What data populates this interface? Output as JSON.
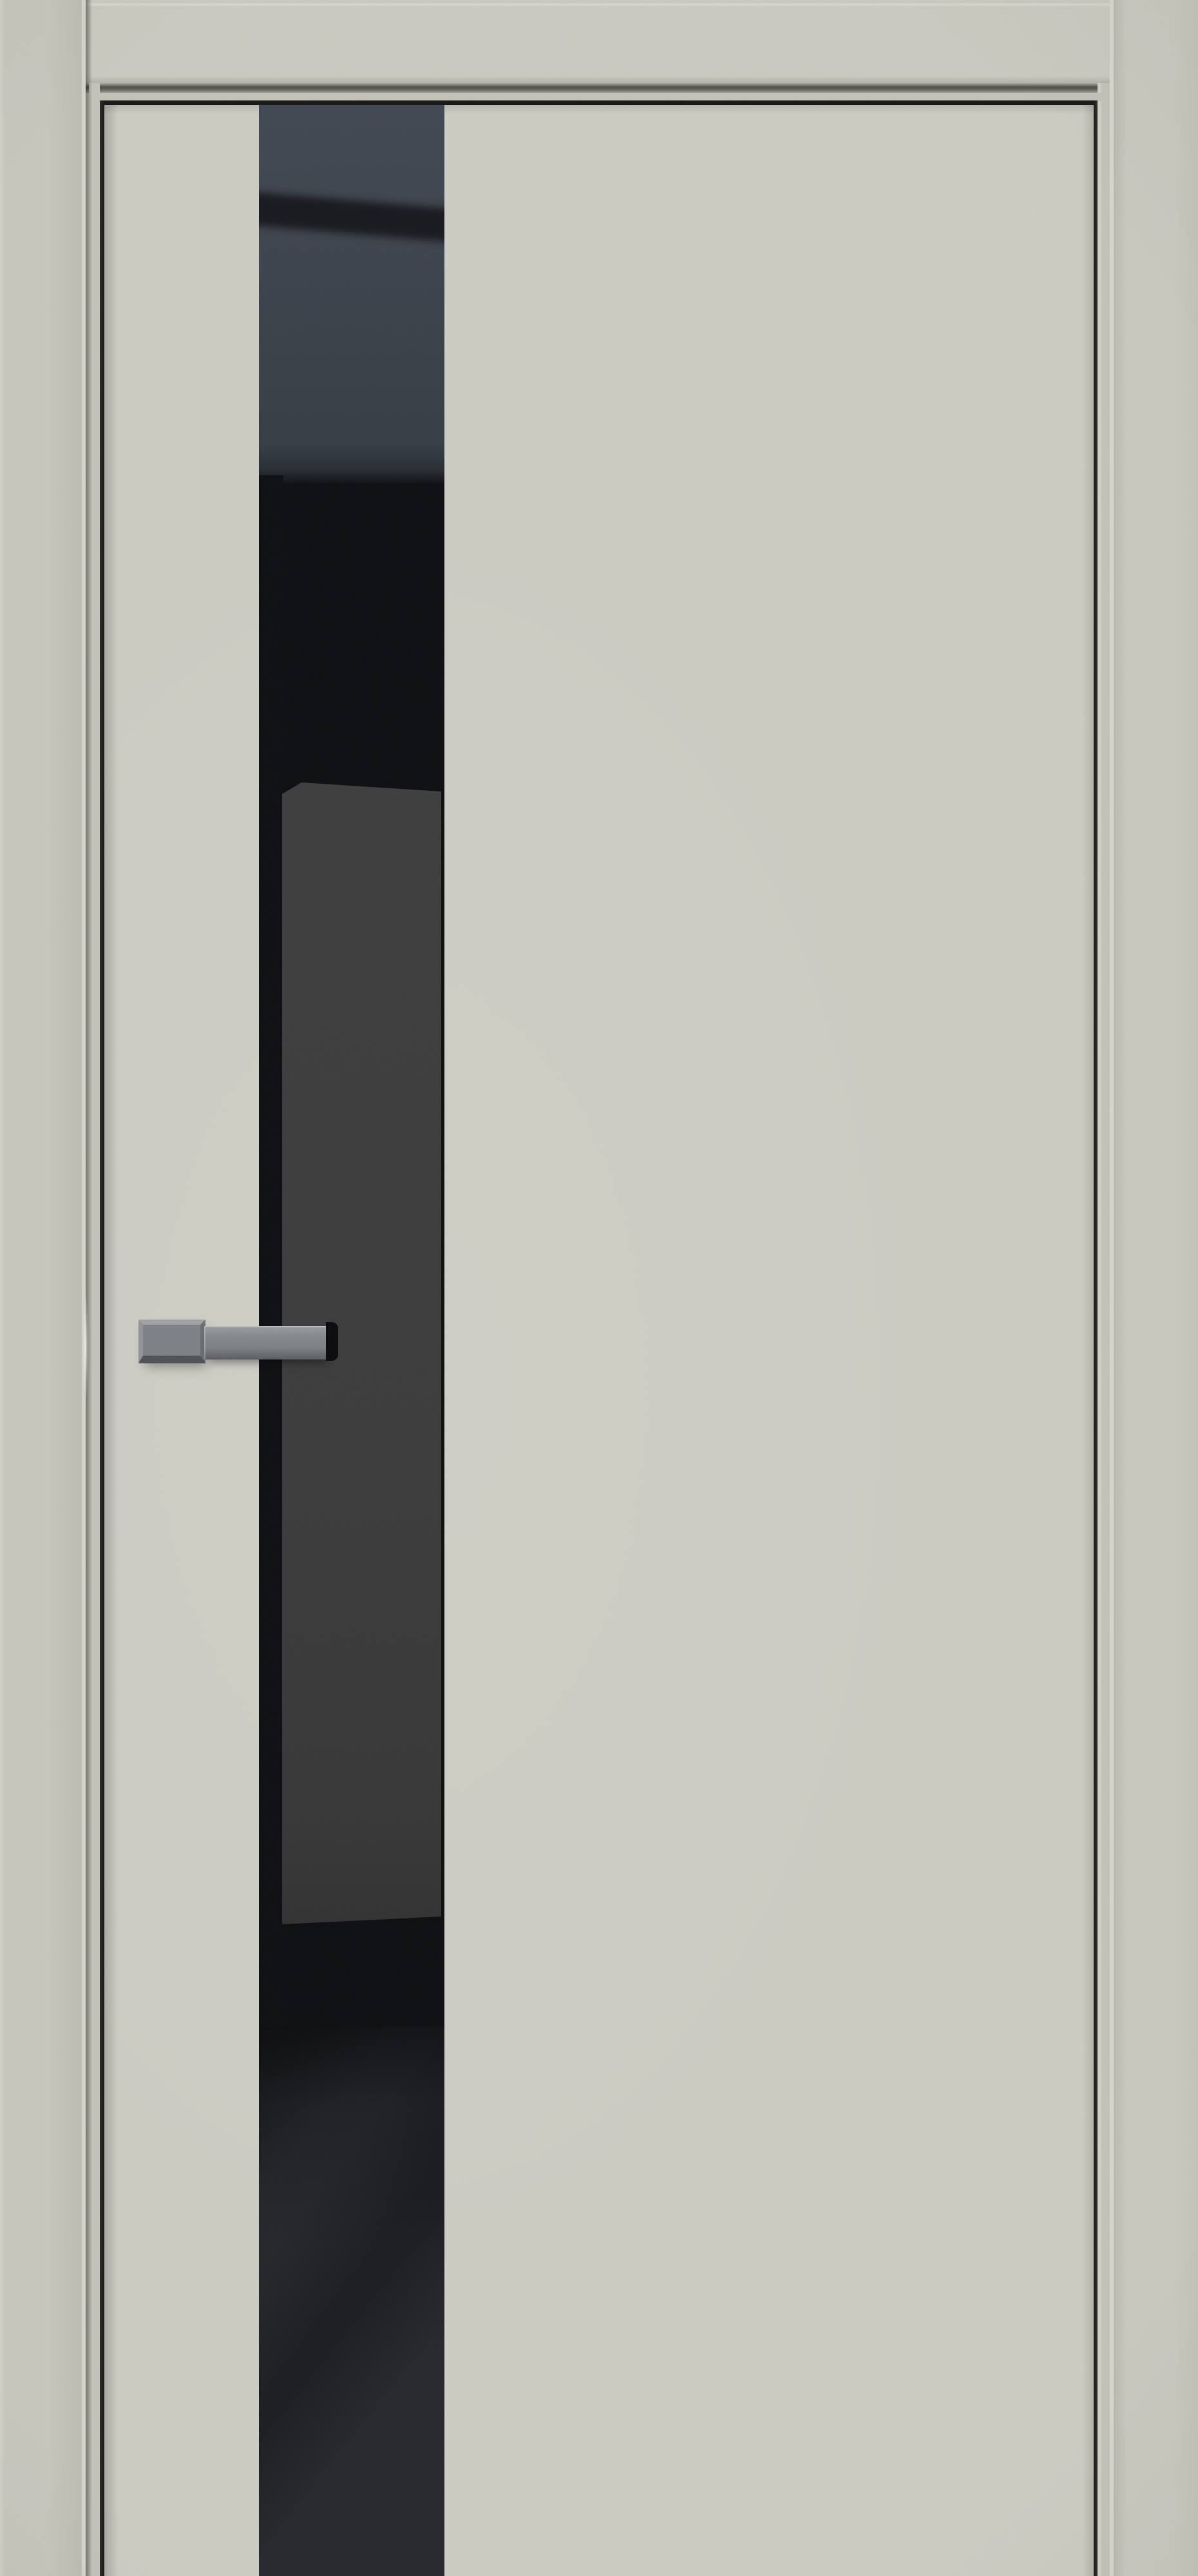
{
  "scene": {
    "type": "product-photo",
    "subject": "interior door with full-height black glass insert strip and lever handle",
    "orientation": "front view, door closed, cropped at bottom edge"
  },
  "colors": {
    "wall": "#c6c6bd",
    "wallRight": "#c8c8bf",
    "wallEdgeLight": "#d8d7ce",
    "jamb": "#c2c2b9",
    "jambRidge": "#d0d0c7",
    "header": "#cac9c0",
    "headerTopEdge": "#d6d5cc",
    "headerBevel": "#b2b1a8",
    "gapDark": "#4f4f48",
    "doorFace": "#cdccc3",
    "doorLine": "#161614",
    "glassBase": "#0c0d10",
    "glassSlateTop": "#414751",
    "glassSlate": "#3b414a",
    "glassBand": "#14151a",
    "glassPanel": "#3b3b3b",
    "glassLower": "#24262b",
    "handleTopBevel": "#9fa2a5",
    "handleBaseFace": "#7d8084",
    "handleFace": "#83868b",
    "handleBottom": "#4e5155",
    "handleCap": "#0a0a0c"
  },
  "parts": [
    {
      "name": "left-wall-casing"
    },
    {
      "name": "right-wall-casing"
    },
    {
      "name": "top-frame-header"
    },
    {
      "name": "door-leaf"
    },
    {
      "name": "glass-insert-strip"
    },
    {
      "name": "lever-handle"
    }
  ]
}
